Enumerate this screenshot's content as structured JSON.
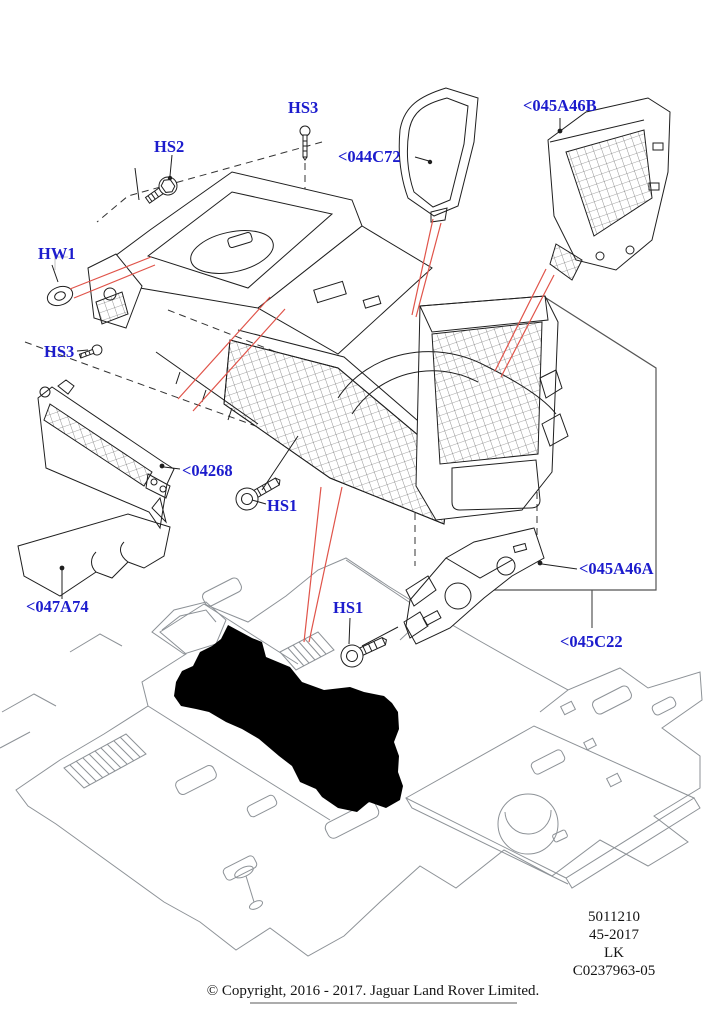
{
  "diagram": {
    "description": "Exploded parts diagram of a vehicle floor console and carpet",
    "callouts": {
      "hs2": "HS2",
      "hs3_top": "HS3",
      "c044c72": "<044C72",
      "c045a46b": "<045A46B",
      "hw1": "HW1",
      "hs3_left": "HS3",
      "c04268": "<04268",
      "hs1_mid": "HS1",
      "c047a74": "<047A74",
      "hs1_bottom": "HS1",
      "c045a46a": "<045A46A",
      "c045c22": "<045C22"
    }
  },
  "footer": {
    "codes": [
      "5011210",
      "45-2017",
      "LK",
      "C0237963-05"
    ],
    "copyright": "© Copyright, 2016 - 2017. Jaguar Land Rover Limited."
  },
  "colors": {
    "callout_blue": "#1c1ccd",
    "leader_red": "#e0544a",
    "line_black": "#1f1f1f",
    "carpet_gray": "#8d9297"
  }
}
